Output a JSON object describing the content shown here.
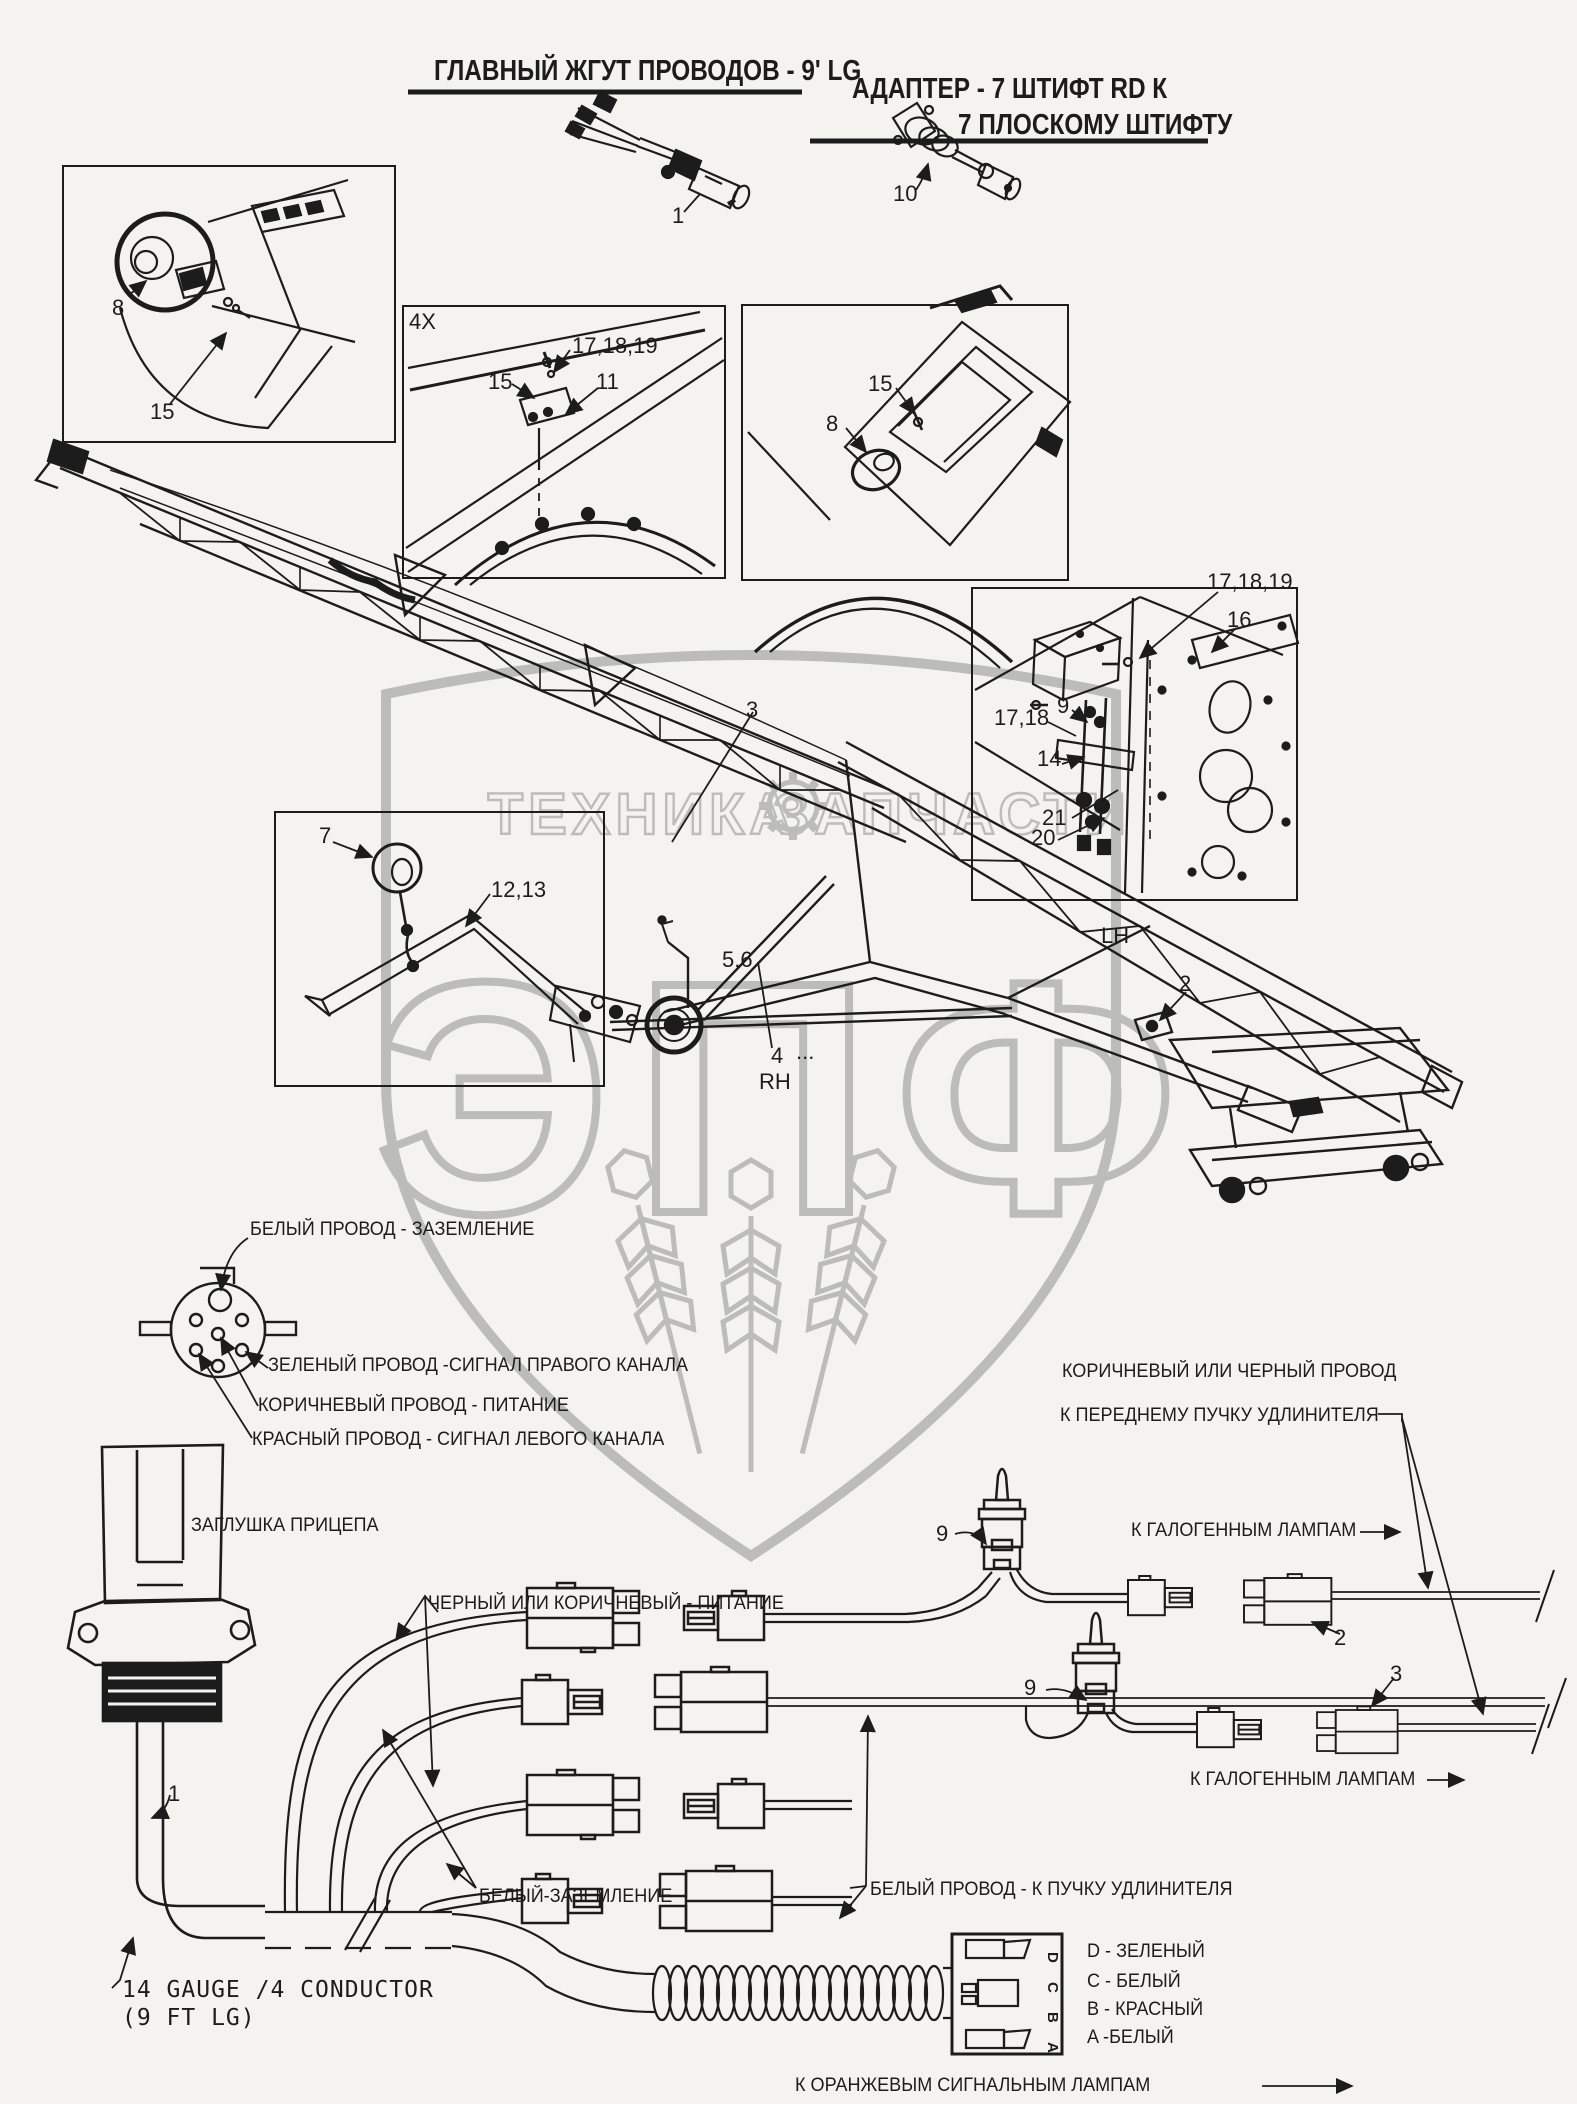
{
  "page": {
    "background": "#f4f3ef",
    "ink": "#1c1c1c",
    "watermark_color": "#bcbcb9"
  },
  "titles": {
    "main": "ГЛАВНЫЙ ЖГУТ ПРОВОДОВ - 9' LG",
    "adapter_line1": "АДАПТЕР - 7 ШТИФТ RD К",
    "adapter_line2": "7 ПЛОСКОМУ ШТИФТУ"
  },
  "watermark": {
    "left": "ТЕХНИКА",
    "right": "ЗАПЧАСТИ",
    "monogram": "ЭПФ"
  },
  "callouts": {
    "top_harness": "1",
    "top_adapter": "10",
    "boxA_8": "8",
    "boxA_15": "15",
    "boxB_mult": "4X",
    "boxB_171819": "17,18,19",
    "boxB_15": "15",
    "boxB_11": "11",
    "boxC_15": "15",
    "boxC_8": "8",
    "boxD_171819": "17,18,19",
    "boxD_16": "16",
    "boxD_9": "9",
    "boxD_1718": "17,18",
    "boxD_14": "14",
    "boxD_21": "21",
    "boxD_20": "20",
    "boom_3": "3",
    "boxE_7": "7",
    "boxE_1213": "12,13",
    "frame_56": "5,6",
    "frame_4": "4",
    "frame_dots": "...",
    "rh": "RH",
    "lh": "LH",
    "machine_2": "2",
    "switch1_9": "9",
    "conn2_2": "2",
    "switch2_9": "9",
    "conn3_3": "3",
    "cable_1": "1"
  },
  "pinout": {
    "white": "БЕЛЫЙ ПРОВОД - ЗАЗЕМЛЕНИЕ",
    "green": "ЗЕЛЕНЫЙ ПРОВОД -СИГНАЛ ПРАВОГО КАНАЛА",
    "brown": "КОРИЧНЕВЫЙ ПРОВОД - ПИТАНИЕ",
    "red": "КРАСНЫЙ ПРОВОД - СИГНАЛ ЛЕВОГО КАНАЛА"
  },
  "labels": {
    "trailer_plug": "ЗАГЛУШКА ПРИЦЕПА",
    "power": "ЧЕРНЫЙ ИЛИ КОРИЧНЕВЫЙ - ПИТАНИЕ",
    "ground": "БЕЛЫЙ-ЗАЗЕМЛЕНИЕ",
    "white_ext": "БЕЛЫЙ ПРОВОД - К ПУЧКУ УДЛИНИТЕЛЯ",
    "brown_black_1": "КОРИЧНЕВЫЙ ИЛИ ЧЕРНЫЙ ПРОВОД",
    "brown_black_2": "К ПЕРЕДНЕМУ ПУЧКУ УДЛИНИТЕЛЯ",
    "halogen_top": "К ГАЛОГЕННЫМ ЛАМПАМ",
    "halogen_bottom": "К ГАЛОГЕННЫМ ЛАМПАМ",
    "orange": "К ОРАНЖЕВЫМ СИГНАЛЬНЫМ ЛАМПАМ",
    "gauge_1": "14 GAUGE /4 CONDUCTOR",
    "gauge_2": "(9 FT LG)"
  },
  "plug_pins": {
    "d": "D - ЗЕЛЕНЫЙ",
    "c": "C - БЕЛЫЙ",
    "b": "B - КРАСНЫЙ",
    "a": "A -БЕЛЫЙ",
    "letters": [
      "D",
      "C",
      "B",
      "A"
    ]
  }
}
